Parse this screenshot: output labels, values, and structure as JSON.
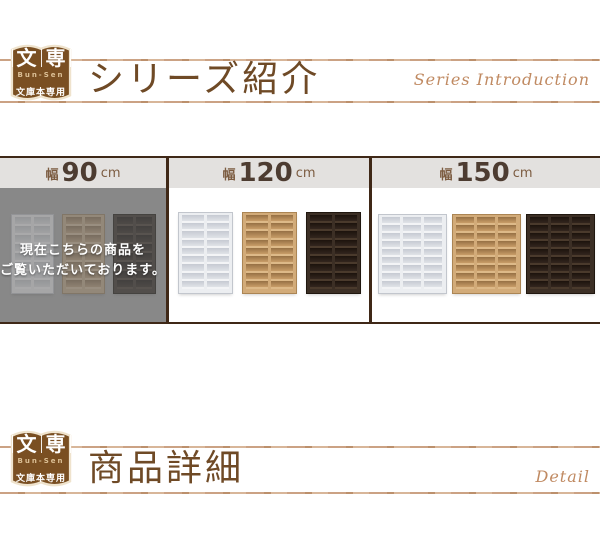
{
  "logo": {
    "kanji_first": "文",
    "kanji_second": "専",
    "romaji": "Bun-Sen",
    "caption": "文庫本専用"
  },
  "sections": [
    {
      "title": "シリーズ紹介",
      "subtitle": "Series Introduction"
    },
    {
      "title": "商品詳細",
      "subtitle": "Detail"
    }
  ],
  "size_nav": {
    "panels": [
      {
        "width_label": "幅",
        "value": "90",
        "unit": "cm",
        "state": "current",
        "overlay_line1": "現在こちらの商品を",
        "overlay_line2": "ご覧いただいております。"
      },
      {
        "width_label": "幅",
        "value": "120",
        "unit": "cm",
        "state": "link"
      },
      {
        "width_label": "幅",
        "value": "150",
        "unit": "cm",
        "state": "link"
      }
    ]
  },
  "shelf_colors": {
    "white": {
      "frame": "#eceef1",
      "board": "#f3f4f6",
      "cell_top": "#c6cad2",
      "cell_bottom": "#e0e3e8",
      "edge": "#c2c6cd"
    },
    "natural": {
      "frame": "#d2ab79",
      "board": "#ddb988",
      "cell_top": "#967044",
      "cell_bottom": "#c89d68",
      "edge": "#ab8554"
    },
    "dark": {
      "frame": "#3c2f25",
      "board": "#4a3a2c",
      "cell_top": "#1c130d",
      "cell_bottom": "#33261e",
      "edge": "#20170f"
    }
  },
  "theme": {
    "accent_brown": "#6f4a26",
    "badge_brown": "#7a4f22",
    "badge_outline": "#efe3cd",
    "line_tan": "#c9a183",
    "band_brown": "#3f2817",
    "header_bg": "#e3e1df",
    "header_number": "#4d3c31",
    "header_label": "#7c5c41",
    "gray_overlay": "#8a8a8a",
    "script_tan": "#c08a62"
  }
}
